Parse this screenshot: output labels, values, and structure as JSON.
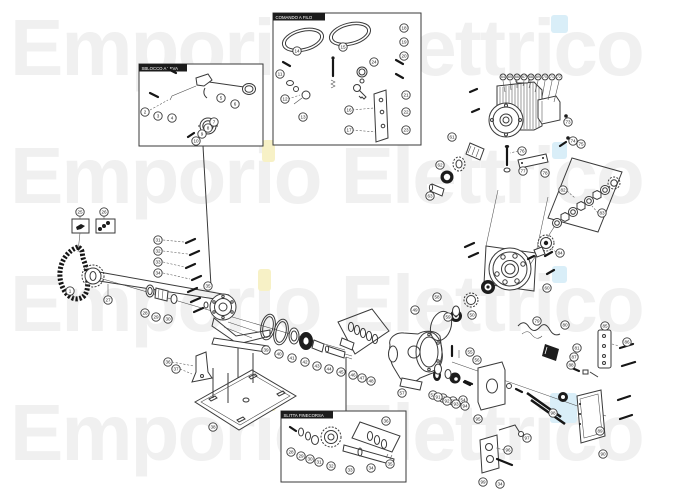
{
  "watermark": {
    "text": "Emporio Elettrico",
    "color": "#f0f0f0",
    "accent_yellow": "#f7f1c6",
    "accent_cyan": "#d9eef8"
  },
  "diagram": {
    "line_color": "#3a3a3a",
    "boxes": [
      {
        "label": "SBLOCCO A LEVA"
      },
      {
        "label": "COMANDO A FILO"
      },
      {
        "label": "SLITTA FINECORSA"
      }
    ],
    "balloons": [
      {
        "n": "2",
        "x": 145,
        "y": 112
      },
      {
        "n": "3",
        "x": 158,
        "y": 116
      },
      {
        "n": "4",
        "x": 172,
        "y": 118
      },
      {
        "n": "5",
        "x": 221,
        "y": 98
      },
      {
        "n": "6",
        "x": 235,
        "y": 104
      },
      {
        "n": "7",
        "x": 214,
        "y": 122
      },
      {
        "n": "8",
        "x": 208,
        "y": 128
      },
      {
        "n": "9",
        "x": 202,
        "y": 134
      },
      {
        "n": "10",
        "x": 196,
        "y": 141
      },
      {
        "n": "11",
        "x": 280,
        "y": 74
      },
      {
        "n": "12",
        "x": 285,
        "y": 99
      },
      {
        "n": "13",
        "x": 303,
        "y": 117
      },
      {
        "n": "14",
        "x": 297,
        "y": 51
      },
      {
        "n": "15",
        "x": 343,
        "y": 47
      },
      {
        "n": "16",
        "x": 349,
        "y": 110
      },
      {
        "n": "17",
        "x": 349,
        "y": 130
      },
      {
        "n": "18",
        "x": 404,
        "y": 28
      },
      {
        "n": "19",
        "x": 404,
        "y": 42
      },
      {
        "n": "20",
        "x": 404,
        "y": 56
      },
      {
        "n": "21",
        "x": 406,
        "y": 95
      },
      {
        "n": "22",
        "x": 406,
        "y": 112
      },
      {
        "n": "23",
        "x": 406,
        "y": 130
      },
      {
        "n": "24",
        "x": 374,
        "y": 62
      },
      {
        "n": "25",
        "x": 80,
        "y": 212
      },
      {
        "n": "26",
        "x": 104,
        "y": 212
      },
      {
        "n": "1",
        "x": 70,
        "y": 291
      },
      {
        "n": "27",
        "x": 108,
        "y": 300
      },
      {
        "n": "28",
        "x": 145,
        "y": 313
      },
      {
        "n": "29",
        "x": 156,
        "y": 317
      },
      {
        "n": "30",
        "x": 168,
        "y": 319
      },
      {
        "n": "31",
        "x": 158,
        "y": 240
      },
      {
        "n": "32",
        "x": 158,
        "y": 251
      },
      {
        "n": "33",
        "x": 158,
        "y": 262
      },
      {
        "n": "34",
        "x": 158,
        "y": 273
      },
      {
        "n": "35",
        "x": 208,
        "y": 286
      },
      {
        "n": "36",
        "x": 168,
        "y": 362
      },
      {
        "n": "37",
        "x": 176,
        "y": 369
      },
      {
        "n": "38",
        "x": 213,
        "y": 427
      },
      {
        "n": "39",
        "x": 266,
        "y": 350
      },
      {
        "n": "40",
        "x": 279,
        "y": 354
      },
      {
        "n": "41",
        "x": 292,
        "y": 358
      },
      {
        "n": "42",
        "x": 305,
        "y": 362
      },
      {
        "n": "43",
        "x": 317,
        "y": 366
      },
      {
        "n": "44",
        "x": 329,
        "y": 369
      },
      {
        "n": "45",
        "x": 341,
        "y": 372
      },
      {
        "n": "46",
        "x": 353,
        "y": 375
      },
      {
        "n": "47",
        "x": 362,
        "y": 378
      },
      {
        "n": "48",
        "x": 371,
        "y": 381
      },
      {
        "n": "49",
        "x": 415,
        "y": 310
      },
      {
        "n": "50",
        "x": 472,
        "y": 315
      },
      {
        "n": "57",
        "x": 402,
        "y": 393
      },
      {
        "n": "51",
        "x": 433,
        "y": 395
      },
      {
        "n": "52",
        "x": 443,
        "y": 398
      },
      {
        "n": "53",
        "x": 453,
        "y": 401
      },
      {
        "n": "54",
        "x": 463,
        "y": 400
      },
      {
        "n": "55",
        "x": 470,
        "y": 352
      },
      {
        "n": "56",
        "x": 477,
        "y": 360
      },
      {
        "n": "58",
        "x": 437,
        "y": 297
      },
      {
        "n": "59",
        "x": 448,
        "y": 317
      },
      {
        "n": "60",
        "x": 547,
        "y": 288
      },
      {
        "n": "61",
        "x": 452,
        "y": 137
      },
      {
        "n": "62",
        "x": 440,
        "y": 165
      },
      {
        "n": "63",
        "x": 430,
        "y": 196
      },
      {
        "n": "64",
        "x": 503,
        "y": 77,
        "s": 1
      },
      {
        "n": "65",
        "x": 510,
        "y": 77,
        "s": 1
      },
      {
        "n": "66",
        "x": 517,
        "y": 77,
        "s": 1
      },
      {
        "n": "67",
        "x": 524,
        "y": 77,
        "s": 1
      },
      {
        "n": "68",
        "x": 531,
        "y": 77,
        "s": 1
      },
      {
        "n": "69",
        "x": 538,
        "y": 77,
        "s": 1
      },
      {
        "n": "70",
        "x": 545,
        "y": 77,
        "s": 1
      },
      {
        "n": "71",
        "x": 552,
        "y": 77,
        "s": 1
      },
      {
        "n": "72",
        "x": 559,
        "y": 77,
        "s": 1
      },
      {
        "n": "73",
        "x": 568,
        "y": 122
      },
      {
        "n": "74",
        "x": 573,
        "y": 141
      },
      {
        "n": "75",
        "x": 581,
        "y": 144
      },
      {
        "n": "76",
        "x": 522,
        "y": 151
      },
      {
        "n": "77",
        "x": 523,
        "y": 171
      },
      {
        "n": "78",
        "x": 545,
        "y": 173
      },
      {
        "n": "79",
        "x": 537,
        "y": 321
      },
      {
        "n": "80",
        "x": 565,
        "y": 325
      },
      {
        "n": "81",
        "x": 577,
        "y": 348
      },
      {
        "n": "82",
        "x": 563,
        "y": 190
      },
      {
        "n": "83",
        "x": 602,
        "y": 213
      },
      {
        "n": "84",
        "x": 560,
        "y": 253
      },
      {
        "n": "85",
        "x": 605,
        "y": 326
      },
      {
        "n": "86",
        "x": 627,
        "y": 342
      },
      {
        "n": "87",
        "x": 574,
        "y": 357
      },
      {
        "n": "88",
        "x": 571,
        "y": 365
      },
      {
        "n": "89",
        "x": 600,
        "y": 431
      },
      {
        "n": "90",
        "x": 603,
        "y": 454
      },
      {
        "n": "91",
        "x": 438,
        "y": 397
      },
      {
        "n": "92",
        "x": 447,
        "y": 401
      },
      {
        "n": "93",
        "x": 456,
        "y": 404
      },
      {
        "n": "94",
        "x": 465,
        "y": 406
      },
      {
        "n": "95",
        "x": 478,
        "y": 419
      },
      {
        "n": "96",
        "x": 508,
        "y": 450
      },
      {
        "n": "97",
        "x": 527,
        "y": 438
      },
      {
        "n": "98",
        "x": 553,
        "y": 413
      },
      {
        "n": "99",
        "x": 483,
        "y": 482
      },
      {
        "n": "34",
        "x": 500,
        "y": 484
      },
      {
        "n": "28",
        "x": 291,
        "y": 452
      },
      {
        "n": "29",
        "x": 301,
        "y": 456
      },
      {
        "n": "30",
        "x": 310,
        "y": 459
      },
      {
        "n": "31",
        "x": 319,
        "y": 462
      },
      {
        "n": "32",
        "x": 331,
        "y": 466
      },
      {
        "n": "33",
        "x": 350,
        "y": 470
      },
      {
        "n": "34",
        "x": 371,
        "y": 468
      },
      {
        "n": "35",
        "x": 390,
        "y": 464
      },
      {
        "n": "36",
        "x": 386,
        "y": 421
      }
    ]
  }
}
